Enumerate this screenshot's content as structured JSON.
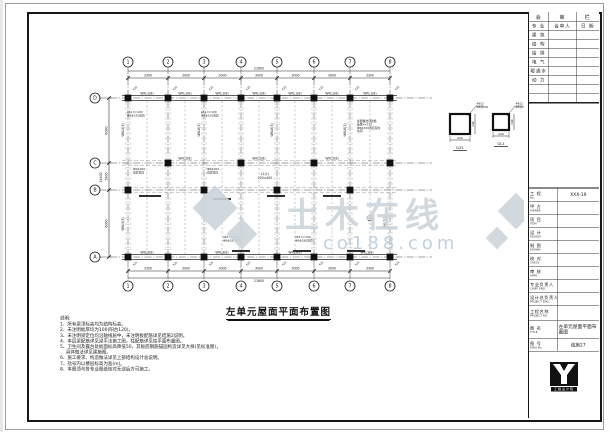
{
  "sheet": {
    "drawing_title": "左单元屋面平面布置图",
    "line_color": "#1a1a1a",
    "watermark_gray": "#cdd5db",
    "watermark_blue": "#b9cbdc"
  },
  "title_block": {
    "review_table": {
      "header": [
        "会",
        "审",
        "栏"
      ],
      "col_headers": [
        "专 业",
        "会审人",
        "日 期"
      ],
      "rows": [
        "建 筑",
        "结 构",
        "给 排",
        "电 气",
        "暖通水",
        "动 力",
        "",
        ""
      ]
    },
    "personnel_rows": [
      {
        "zh": "工 程",
        "en": "No.",
        "value": "XXX-19"
      },
      {
        "zh": "甲 方",
        "en": "OWNER",
        "value": ""
      },
      {
        "zh": "项 目",
        "en": "ITEM",
        "value": ""
      },
      {
        "zh": "设 计",
        "en": "DESIGN",
        "value": ""
      },
      {
        "zh": "制 图",
        "en": "DRAWN",
        "value": ""
      },
      {
        "zh": "校 对",
        "en": "CHECK",
        "value": ""
      },
      {
        "zh": "审 核",
        "en": "APPR.",
        "value": ""
      },
      {
        "zh": "专业负责人",
        "en": "CHIEF ENG.",
        "value": ""
      },
      {
        "zh": "设计总负责人",
        "en": "PROJECT ENG.",
        "value": ""
      }
    ],
    "project_name": {
      "zh": "工程名称",
      "en": "PROJECT NO.",
      "value": ""
    },
    "title_row": {
      "zh": "图 名",
      "en": "TITLE",
      "value": "左单元屋面平面布置图"
    },
    "dwg_row": {
      "zh": "图 号",
      "en": "DWG No.",
      "value": "结施27"
    },
    "logo_strip_text": "工程设计院"
  },
  "plan": {
    "grid_cols": [
      {
        "label": "1",
        "x": 101
      },
      {
        "label": "2",
        "x": 141
      },
      {
        "label": "3",
        "x": 177
      },
      {
        "label": "4",
        "x": 214
      },
      {
        "label": "5",
        "x": 250
      },
      {
        "label": "6",
        "x": 287
      },
      {
        "label": "7",
        "x": 323
      },
      {
        "label": "8",
        "x": 363
      }
    ],
    "grid_rows": [
      {
        "label": "D",
        "y": 86
      },
      {
        "label": "C",
        "y": 151
      },
      {
        "label": "B",
        "y": 178
      },
      {
        "label": "A",
        "y": 245
      }
    ],
    "bubbles": {
      "top_y": 50,
      "bottom_y": 274,
      "left_x": 68,
      "r": 5
    },
    "dims_top": {
      "seg_y": 66,
      "overall_y": 59,
      "segments": [
        "3300",
        "3000",
        "3000",
        "3000",
        "3000",
        "3000",
        "3300"
      ],
      "overall": "21600"
    },
    "dims_bottom": {
      "seg_y": 259,
      "overall_y": 266,
      "segments": [
        "3300",
        "3000",
        "3000",
        "3000",
        "3000",
        "3000",
        "3300"
      ],
      "overall": "21600"
    },
    "dims_left": {
      "seg_x": 82,
      "overall_x": 75,
      "segments": [
        "6000",
        "2400",
        "6000"
      ],
      "overall": "14400"
    },
    "columns_D": [
      101,
      141,
      177,
      214,
      250,
      287,
      323,
      363
    ],
    "columns_A": [
      101,
      141,
      177,
      214,
      250,
      287,
      323,
      363
    ],
    "columns_C": [
      141,
      214,
      287,
      363
    ],
    "columns_B": [
      101,
      177,
      250,
      323
    ],
    "mid_dashed_x": [
      120,
      158,
      195,
      232,
      268,
      305,
      343
    ],
    "col_tag": "KZ1",
    "beam_marks": [
      {
        "x": 112,
        "y": 184,
        "len": 22
      },
      {
        "x": 186,
        "y": 187,
        "len": 18
      },
      {
        "x": 240,
        "y": 184,
        "len": 18
      },
      {
        "x": 296,
        "y": 184,
        "len": 18
      },
      {
        "x": 205,
        "y": 239,
        "len": 18
      },
      {
        "x": 266,
        "y": 239,
        "len": 18
      },
      {
        "x": 320,
        "y": 239,
        "len": 18
      }
    ],
    "labels": [
      {
        "t": "WKL1(8)",
        "x": 120,
        "y": 82.5
      },
      {
        "t": "WKL1(8)",
        "x": 158,
        "y": 82.5
      },
      {
        "t": "WKL1(8)",
        "x": 195,
        "y": 82.5
      },
      {
        "t": "WKL1(8)",
        "x": 232,
        "y": 82.5
      },
      {
        "t": "WKL1(8)",
        "x": 268,
        "y": 82.5
      },
      {
        "t": "WKL1(8)",
        "x": 305,
        "y": 82.5
      },
      {
        "t": "WKL1(8)",
        "x": 343,
        "y": 82.5
      },
      {
        "t": "WKL2(8)",
        "x": 158,
        "y": 147.5
      },
      {
        "t": "WKL2(8)",
        "x": 232,
        "y": 147.5
      },
      {
        "t": "WKL2(8)",
        "x": 305,
        "y": 147.5
      },
      {
        "t": "WKL3(8)",
        "x": 120,
        "y": 241.5
      },
      {
        "t": "WKL3(8)",
        "x": 195,
        "y": 241.5
      },
      {
        "t": "WKL3(8)",
        "x": 268,
        "y": 241.5
      },
      {
        "t": "WKL3(8)",
        "x": 340,
        "y": 241.5
      },
      {
        "t": "WKL5(3)",
        "x": 97,
        "y": 118,
        "r": -90
      },
      {
        "t": "WKL6(3)",
        "x": 173,
        "y": 118,
        "r": -90
      },
      {
        "t": "WKL6(3)",
        "x": 246,
        "y": 118,
        "r": -90
      },
      {
        "t": "WKL6(3)",
        "x": 319,
        "y": 118,
        "r": -90
      },
      {
        "t": "WKL7(3)",
        "x": 359,
        "y": 210,
        "r": -90
      },
      {
        "t": "WKL5(3)",
        "x": 97,
        "y": 212,
        "r": -90
      },
      {
        "t": "L1(1)",
        "x": 238,
        "y": 163
      },
      {
        "t": "200×400",
        "x": 238,
        "y": 167
      }
    ],
    "clusters": [
      {
        "x": 100,
        "y": 101,
        "lines": [
          "LB1 h=100",
          "Φ8@150双向"
        ]
      },
      {
        "x": 174,
        "y": 101,
        "lines": [
          "LB1 h=100",
          "Φ8@150双向"
        ]
      },
      {
        "x": 106,
        "y": 158,
        "lines": [
          "Φ8@200",
          "双层双向"
        ]
      },
      {
        "x": 180,
        "y": 158,
        "lines": [
          "Φ8@200",
          "双层双向"
        ]
      },
      {
        "x": 330,
        "y": 110,
        "lines": [
          "屋面做法详建施",
          "板厚h=120",
          "Φ8@150双层双向",
          "余同"
        ]
      },
      {
        "x": 196,
        "y": 226,
        "lines": [
          "LB2 h=100",
          "Φ8@180双向"
        ]
      },
      {
        "x": 268,
        "y": 226,
        "lines": [
          "LB2 h=100",
          "Φ8@180双向"
        ]
      }
    ],
    "details": [
      {
        "cx": 433,
        "cy": 112,
        "s": 20,
        "label": "GZ1",
        "dim": "240",
        "notes": [
          "4Φ12",
          "Φ6@200"
        ]
      },
      {
        "cx": 474,
        "cy": 110,
        "s": 16,
        "label": "GL1",
        "dim": "240",
        "notes": [
          "4Φ12",
          "Φ6@200"
        ]
      }
    ],
    "marker_circle": {
      "x": 343,
      "y": 206
    }
  },
  "watermark": {
    "text1": "土木在线",
    "text2": "co188.com",
    "diamonds": [
      {
        "x": 188,
        "y": 196,
        "r": 16
      },
      {
        "x": 215,
        "y": 222,
        "r": 11
      },
      {
        "x": 489,
        "y": 199,
        "r": 13
      },
      {
        "x": 470,
        "y": 226,
        "r": 8
      }
    ]
  },
  "notes": {
    "heading": "说明:",
    "lines": [
      "1、所有梁顶标高均为结构标高。",
      "2、未注明板厚均为100(阳台120)。",
      "3、未注明梁定位均沿轴线居中，未注明板配筋详见结施2说明。",
      "4、本层梁配筋详见梁平法施工图，柱配筋详见柱平面布置图。",
      "5、卫生间及露台处板面标高降低50，其板底钢筋锚固构造详见大样(见标准图)，",
      "　  具体做法详见建施图。",
      "6、施工要求、构造做法详见上部结构设计总说明。",
      "7、括号内以楼层标高为准(m)。",
      "8、本图须与各专业图纸核对无误后方可施工。"
    ]
  }
}
